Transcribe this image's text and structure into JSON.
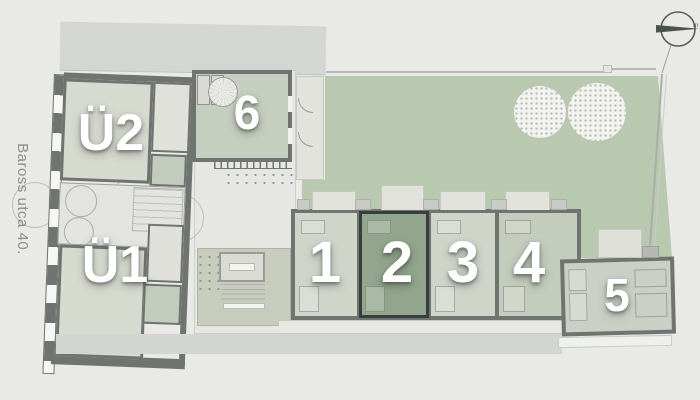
{
  "street": {
    "label": "Baross utca 40."
  },
  "units": [
    {
      "id": "U2",
      "label": "Ü2",
      "selected": false
    },
    {
      "id": "U1",
      "label": "Ü1",
      "selected": false
    },
    {
      "id": "6",
      "label": "6",
      "selected": false
    },
    {
      "id": "1",
      "label": "1",
      "selected": false
    },
    {
      "id": "2",
      "label": "2",
      "selected": true
    },
    {
      "id": "3",
      "label": "3",
      "selected": false
    },
    {
      "id": "4",
      "label": "4",
      "selected": false
    },
    {
      "id": "5",
      "label": "5",
      "selected": false
    }
  ],
  "compass": {
    "label": "m"
  },
  "colors": {
    "background": "#e9eae8",
    "neighbor_band": "#d4d6d3",
    "garden": "#b8c9af",
    "wall": "#6f7471",
    "unit_fill": "#d0d5ca",
    "unit4_fill": "#c4ccbd",
    "unit6_fill": "#c6cec0",
    "selected_fill": "#92a58d",
    "selected_border": "#383e3b",
    "terrace": "#e1e2da",
    "patio": "#c8ccbd",
    "label_text": "#ffffff",
    "street_text": "#8b8d8a"
  }
}
